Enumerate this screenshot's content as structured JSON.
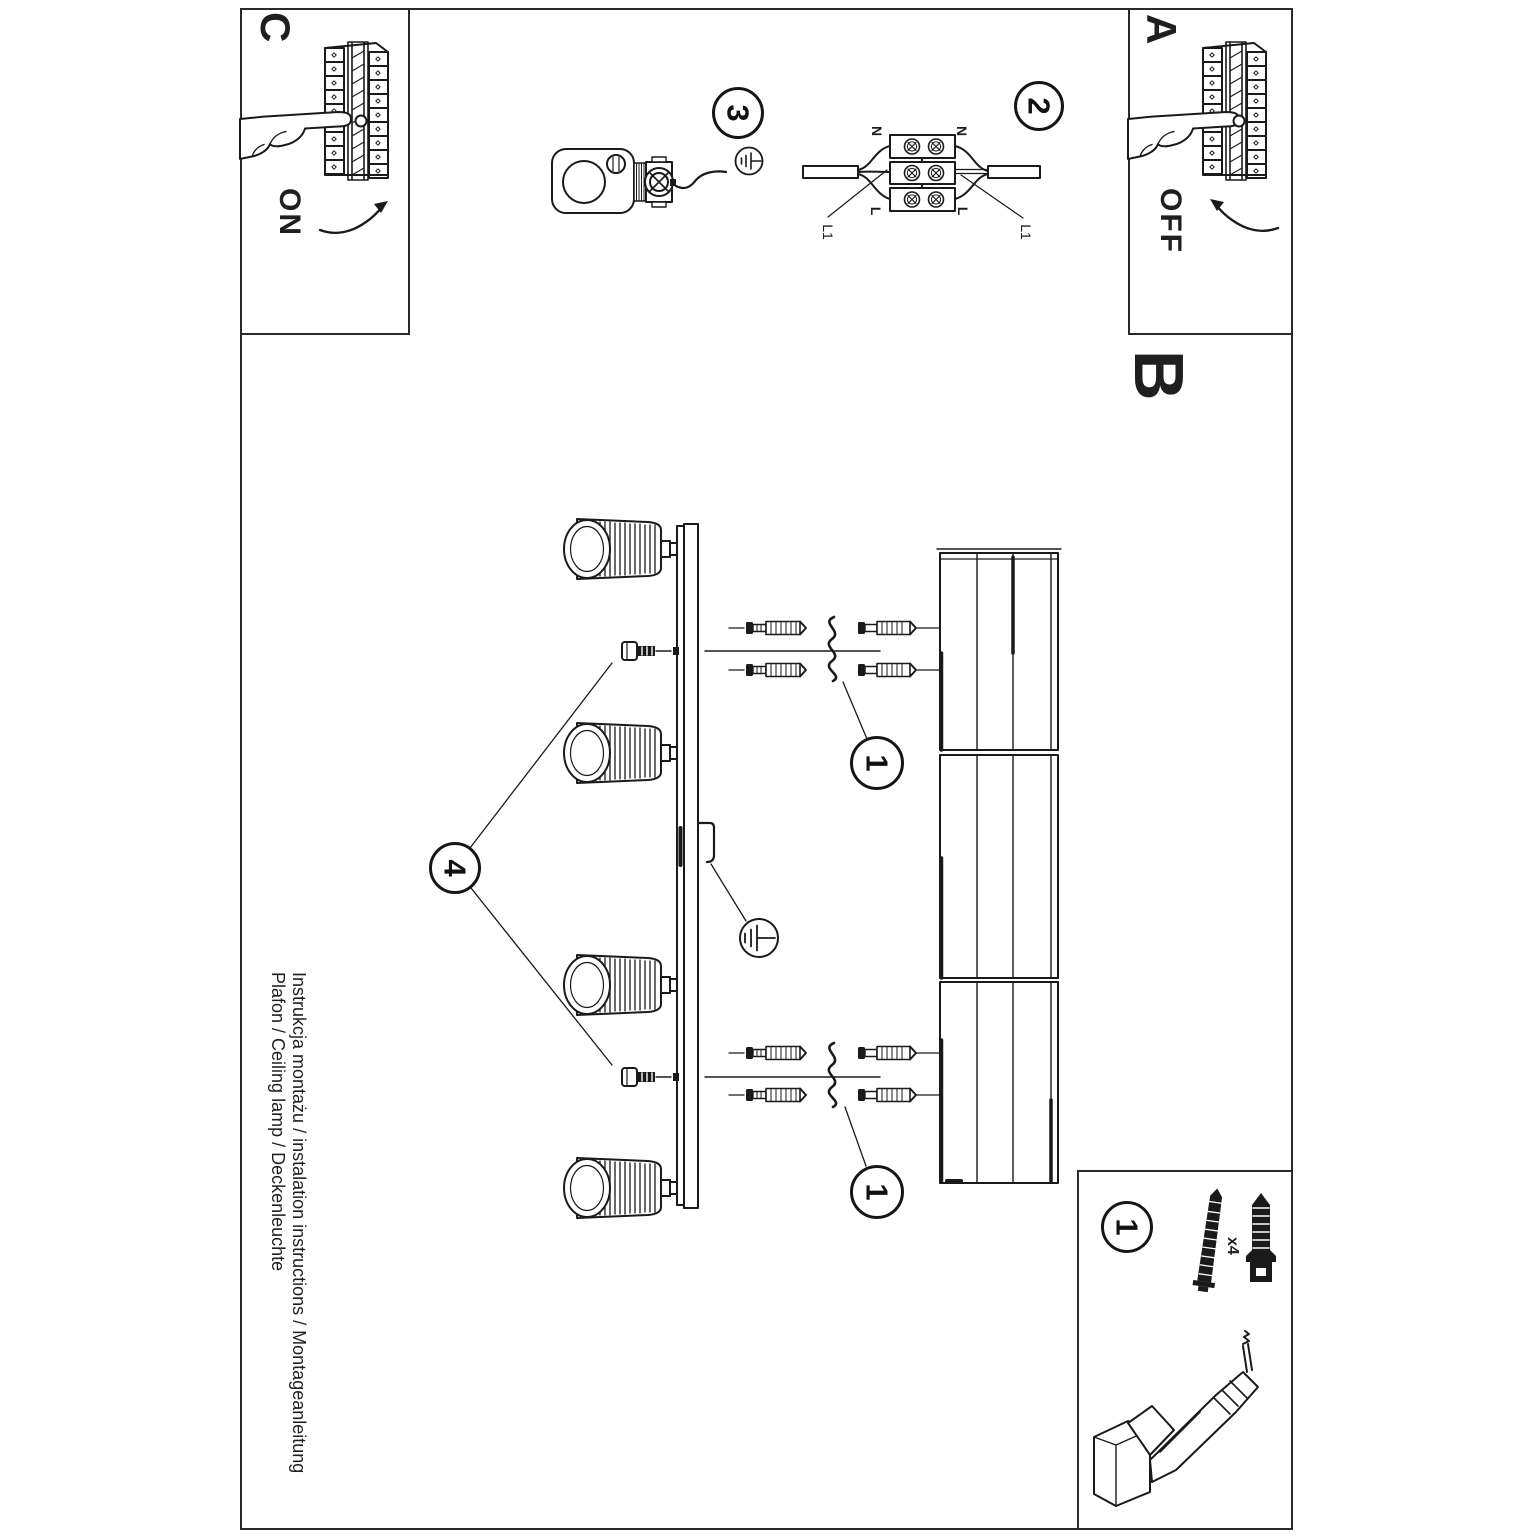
{
  "sheet": {
    "power_on": {
      "label": "C",
      "state": "ON"
    },
    "power_off": {
      "label": "A",
      "state": "OFF"
    },
    "section_b_label": "B",
    "step_1": "1",
    "step_2": "2",
    "step_3": "3",
    "step_4": "4",
    "kit_quantity": "x4",
    "wiring": {
      "neutral": "N",
      "line": "L",
      "line1": "L1"
    },
    "footer": {
      "line1": "Instrukcja montażu / instalation instructions / Montageanleitung",
      "line2": "Plafon / Ceiling lamp / Deckenleuchte"
    }
  },
  "colors": {
    "ink": "#1a1a1a",
    "paper": "#ffffff"
  }
}
